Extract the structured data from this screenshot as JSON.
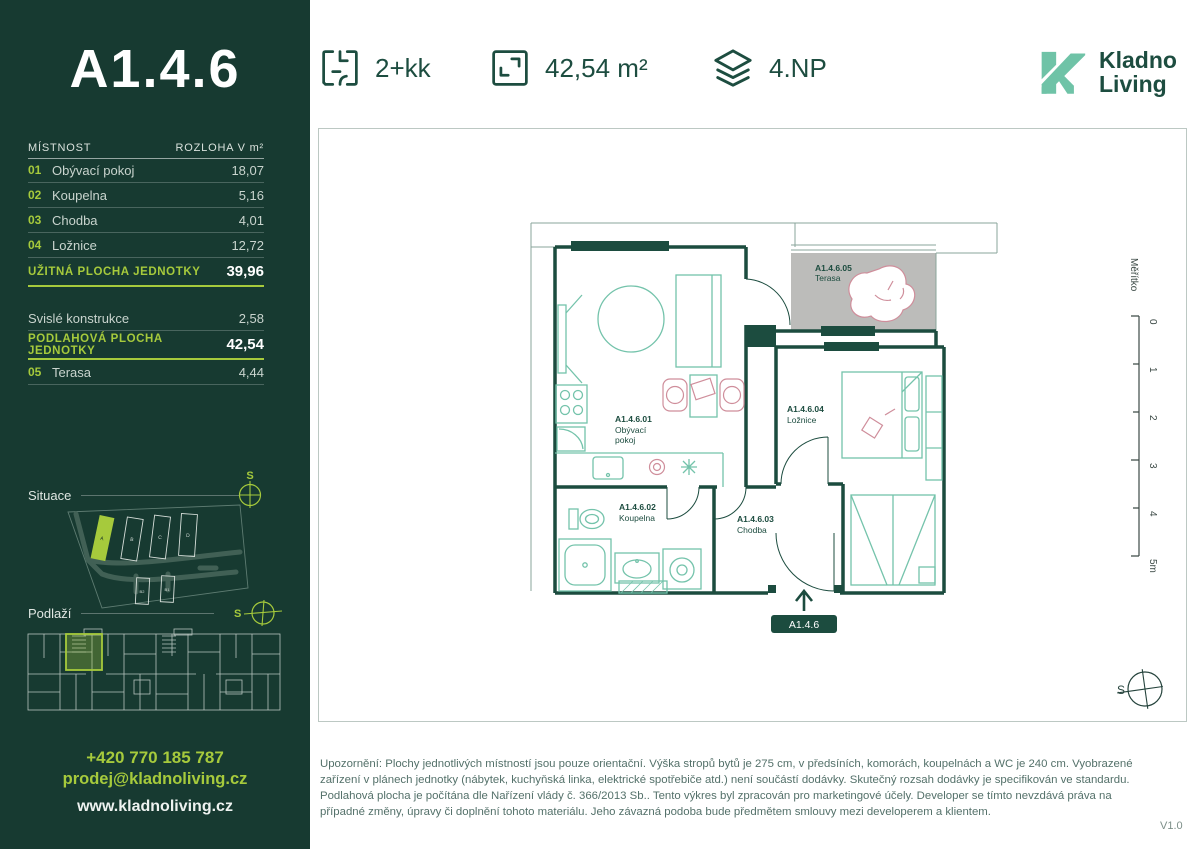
{
  "colors": {
    "accent_lime": "#a6ca3c",
    "dark_green": "#1d4d40",
    "sidebar_bg": "#173a31",
    "logo_mint": "#6fc3a7",
    "terrace_gray": "#bcbcba",
    "furniture_teal": "#74c3ab",
    "furniture_pink": "#cf8e9b"
  },
  "sidebar": {
    "unit_title": "A1.4.6",
    "table": {
      "header": {
        "room": "MÍSTNOST",
        "area": "ROZLOHA V m²"
      },
      "rows": [
        {
          "num": "01",
          "name": "Obývací pokoj",
          "area": "18,07"
        },
        {
          "num": "02",
          "name": "Koupelna",
          "area": "5,16"
        },
        {
          "num": "03",
          "name": "Chodba",
          "area": "4,01"
        },
        {
          "num": "04",
          "name": "Ložnice",
          "area": "12,72"
        }
      ],
      "usable": {
        "label": "UŽITNÁ PLOCHA JEDNOTKY",
        "value": "39,96"
      },
      "construction": {
        "label": "Svislé konstrukce",
        "value": "2,58"
      },
      "floor_area": {
        "label": "PODLAHOVÁ PLOCHA JEDNOTKY",
        "value": "42,54"
      },
      "terrace_row": {
        "num": "05",
        "name": "Terasa",
        "area": "4,44"
      }
    },
    "situace_label": "Situace",
    "podlazi_label": "Podlaží",
    "north": "S",
    "site_buildings": [
      "A",
      "B",
      "C",
      "D",
      "B2",
      "B1"
    ],
    "phone": "+420 770 185 787",
    "email": "prodej@kladnoliving.cz",
    "web": "www.kladnoliving.cz"
  },
  "header": {
    "disposition": "2+kk",
    "area": "42,54 m²",
    "floor": "4.NP",
    "logo_line1": "Kladno",
    "logo_line2": "Living"
  },
  "plan": {
    "labels": {
      "living_id": "A1.4.6.01",
      "living_l1": "Obývací",
      "living_l2": "pokoj",
      "bath_id": "A1.4.6.02",
      "bath": "Koupelna",
      "hall_id": "A1.4.6.03",
      "hall": "Chodba",
      "bed_id": "A1.4.6.04",
      "bed": "Ložnice",
      "terrace_id": "A1.4.6.05",
      "terrace": "Terasa"
    },
    "entry_badge": "A1.4.6",
    "north": "S",
    "scale": {
      "label": "Měřítko",
      "ticks": [
        "0",
        "1",
        "2",
        "3",
        "4",
        "5m"
      ]
    }
  },
  "footer": {
    "disclaimer": "Upozornění: Plochy jednotlivých místností jsou pouze orientační. Výška stropů bytů je 275 cm, v předsíních, komorách, koupelnách a WC je 240 cm. Vyobrazené zařízení v plánech jednotky (nábytek, kuchyňská linka, elektrické spotřebiče atd.) není součástí dodávky. Skutečný rozsah dodávky je specifikován ve standardu. Podlahová plocha je počítána dle Nařízení vlády č. 366/2013 Sb.. Tento výkres byl zpracován pro marketingové účely. Developer se tímto nevzdává práva na případné změny, úpravy či doplnění tohoto materiálu. Jeho závazná podoba bude předmětem smlouvy mezi developerem a klientem.",
    "version": "V1.0"
  }
}
